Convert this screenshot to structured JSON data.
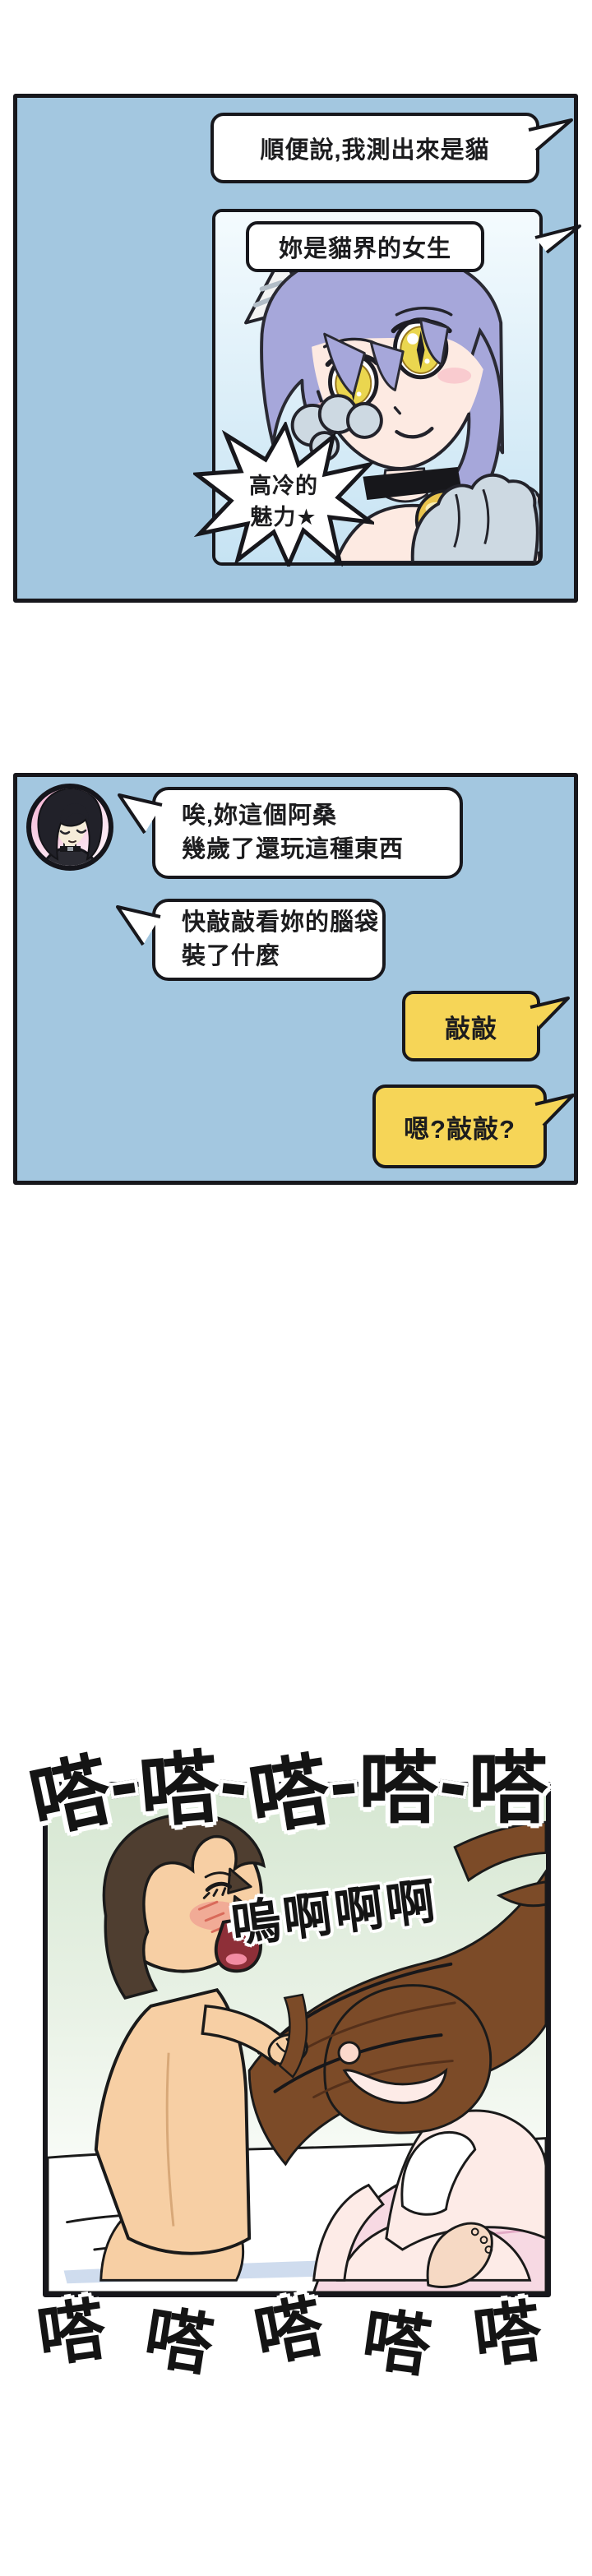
{
  "colors": {
    "panel_blue": "#a3c7e0",
    "bubble_yellow": "#f6d557",
    "ink": "#17171c",
    "panel_green": "#d7e8d3",
    "sfx_outline": "#ffffff"
  },
  "panel1": {
    "bubble1_text": "順便說,我測出來是貓",
    "bubble2_text": "妳是貓界的女生",
    "starburst_line1": "高冷的",
    "starburst_line2": "魅力★",
    "illustration": "cat-ear-girl-portrait"
  },
  "panel2": {
    "avatar": "black-bob-hair-woman-avatar",
    "left_bubble1": {
      "line1": "唉,妳這個阿桑",
      "line2": "幾歲了還玩這種東西"
    },
    "left_bubble2": {
      "line1": "快敲敲看妳的腦袋",
      "line2": "裝了什麼"
    },
    "right_bubble1": "敲敲",
    "right_bubble2": "嗯?敲敲?"
  },
  "panel3": {
    "sfx_top": [
      "嗒",
      "嗒",
      "嗒",
      "嗒",
      "嗒"
    ],
    "scream": "嗚啊啊啊",
    "sfx_bottom": [
      "嗒",
      "嗒",
      "嗒",
      "嗒",
      "嗒"
    ],
    "illustration": "bedroom-hair-grab-scene"
  }
}
